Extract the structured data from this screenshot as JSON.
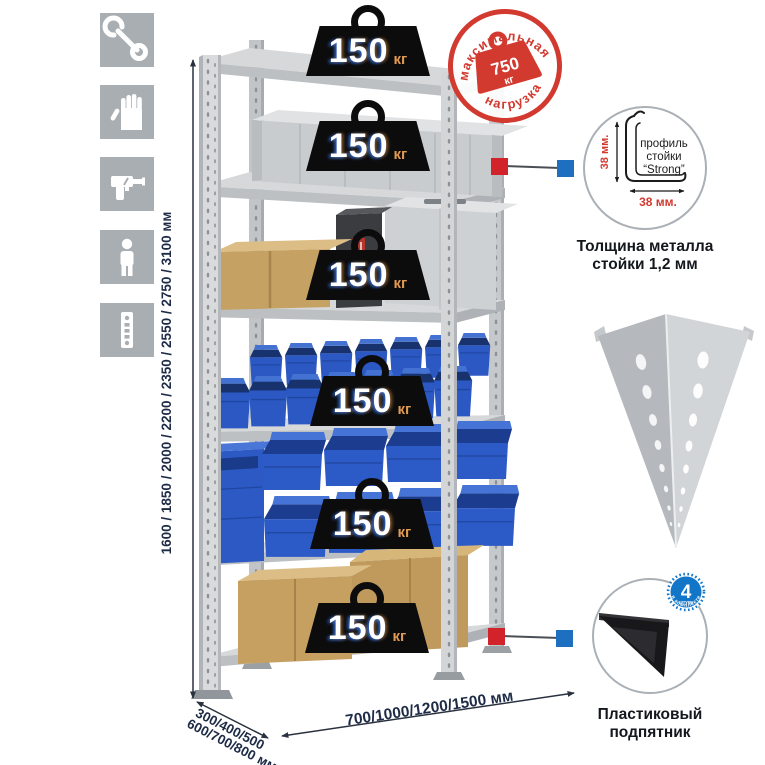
{
  "sidebar": {
    "icons": [
      {
        "name": "wrench"
      },
      {
        "name": "work-gloves"
      },
      {
        "name": "drill"
      },
      {
        "name": "person"
      },
      {
        "name": "rack-post"
      }
    ]
  },
  "dimensions": {
    "height": "1600 / 1850 / 2000 / 2200 / 2350 / 2550 / 2750 / 3100 мм",
    "depth_line1": "300/400/500",
    "depth_line2": "600/700/800 мм",
    "width": "700/1000/1200/1500 мм"
  },
  "shelves": [
    {
      "load": "150",
      "unit": "кг"
    },
    {
      "load": "150",
      "unit": "кг"
    },
    {
      "load": "150",
      "unit": "кг"
    },
    {
      "load": "150",
      "unit": "кг"
    },
    {
      "load": "150",
      "unit": "кг"
    },
    {
      "load": "150",
      "unit": "кг"
    }
  ],
  "stamp": {
    "arc_top": "максимальная",
    "arc_bottom": "нагрузка",
    "value": "750",
    "unit": "кг"
  },
  "profile": {
    "label1": "профиль",
    "label2": "стойки",
    "label3": "“Strong”",
    "dim_vertical": "38 мм.",
    "dim_horizontal": "38 мм.",
    "caption1": "Толщина металла",
    "caption2": "стойки 1,2 мм"
  },
  "foot": {
    "count": "4",
    "count_note": "штуки",
    "arc_text": "в комплекте",
    "caption1": "Пластиковый",
    "caption2": "подпятник"
  },
  "colors": {
    "accent_red": "#d23a30",
    "accent_blue": "#1e6fc0",
    "bin_blue": "#2c5ac6",
    "metal_gray": "#c9ccce",
    "navy_text": "#1e2b47",
    "badge_black": "#0c0c0d",
    "kg_orange": "#e09a52"
  }
}
